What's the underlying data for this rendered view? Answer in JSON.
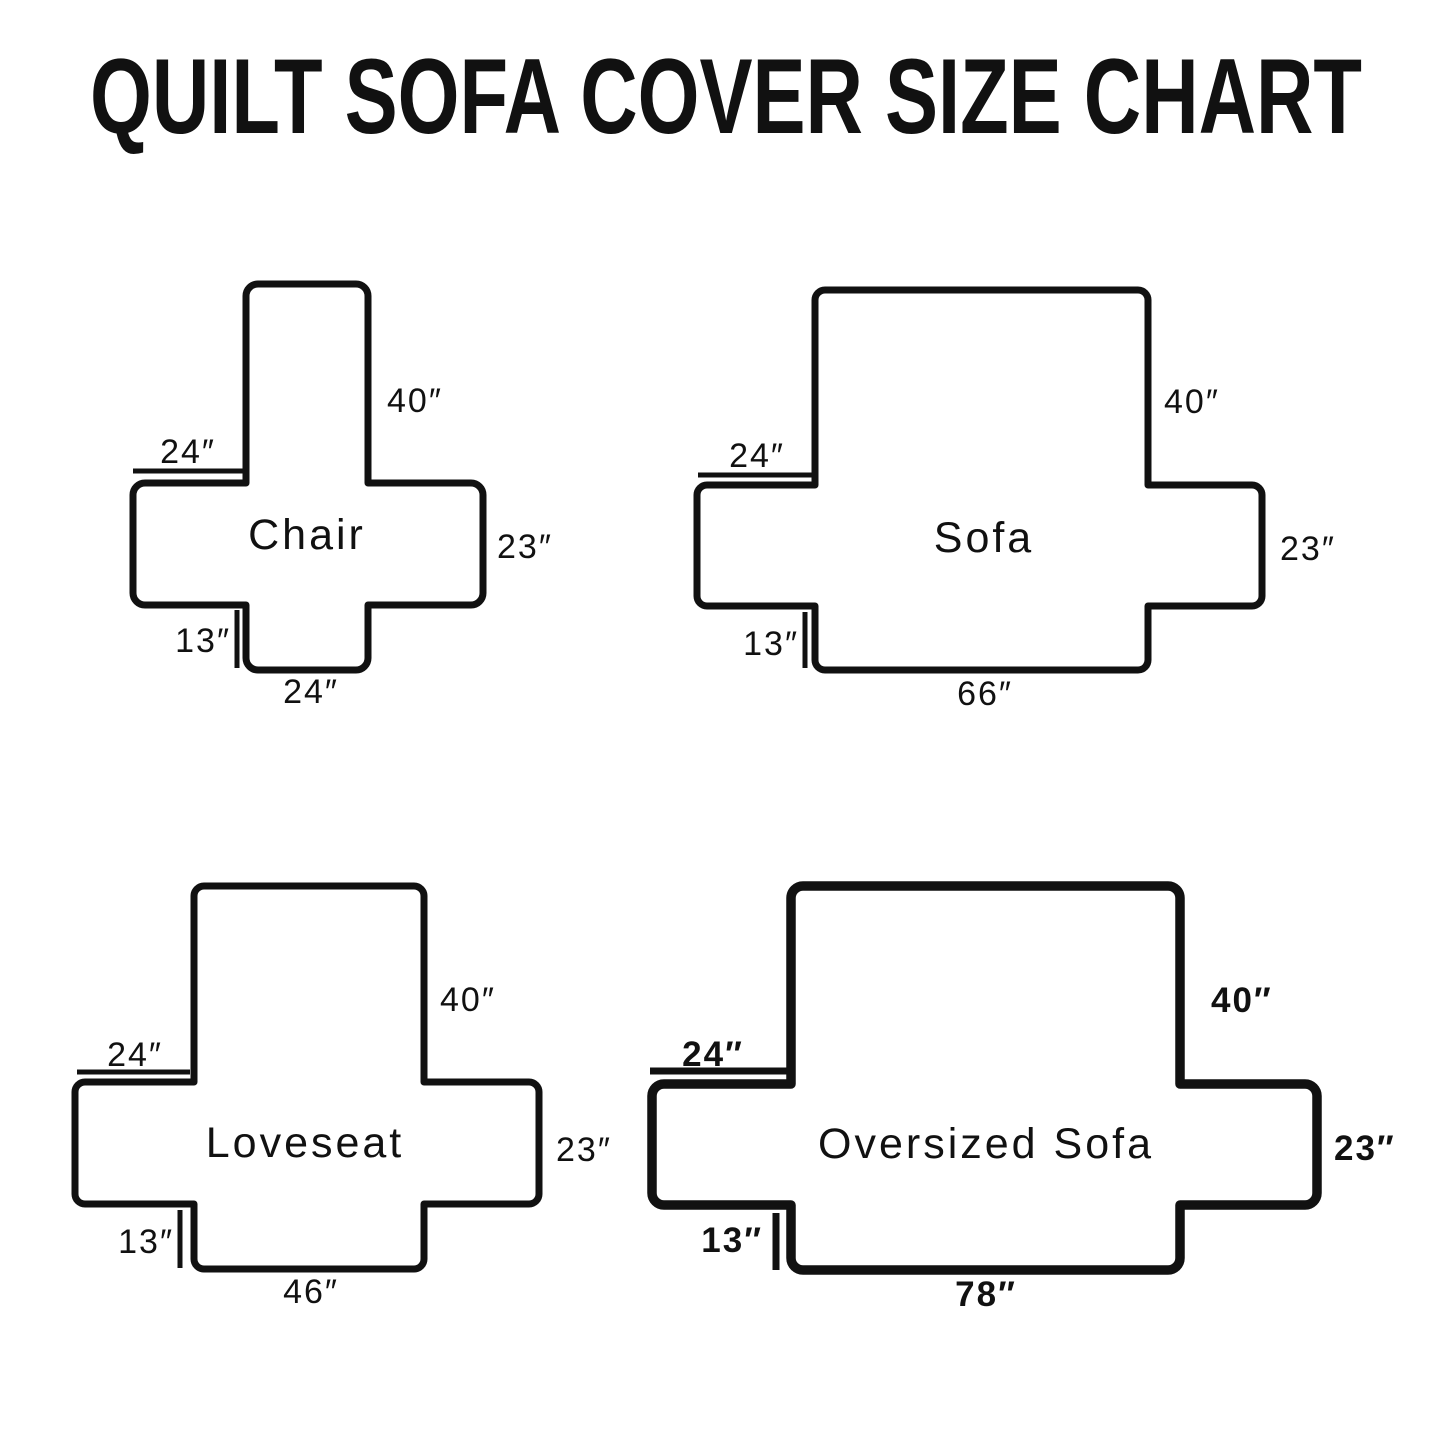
{
  "title": "QUILT SOFA COVER SIZE CHART",
  "colors": {
    "ink": "#111111",
    "background": "#ffffff"
  },
  "diagrams": {
    "chair": {
      "name": "Chair",
      "back_height": "40″",
      "arm_width": "24″",
      "side_height": "23″",
      "skirt_height": "13″",
      "seat_width": "24″"
    },
    "sofa": {
      "name": "Sofa",
      "back_height": "40″",
      "arm_width": "24″",
      "side_height": "23″",
      "skirt_height": "13″",
      "seat_width": "66″"
    },
    "loveseat": {
      "name": "Loveseat",
      "back_height": "40″",
      "arm_width": "24″",
      "side_height": "23″",
      "skirt_height": "13″",
      "seat_width": "46″"
    },
    "oversized_sofa": {
      "name": "Oversized Sofa",
      "back_height": "40″",
      "arm_width": "24″",
      "side_height": "23″",
      "skirt_height": "13″",
      "seat_width": "78″"
    }
  }
}
